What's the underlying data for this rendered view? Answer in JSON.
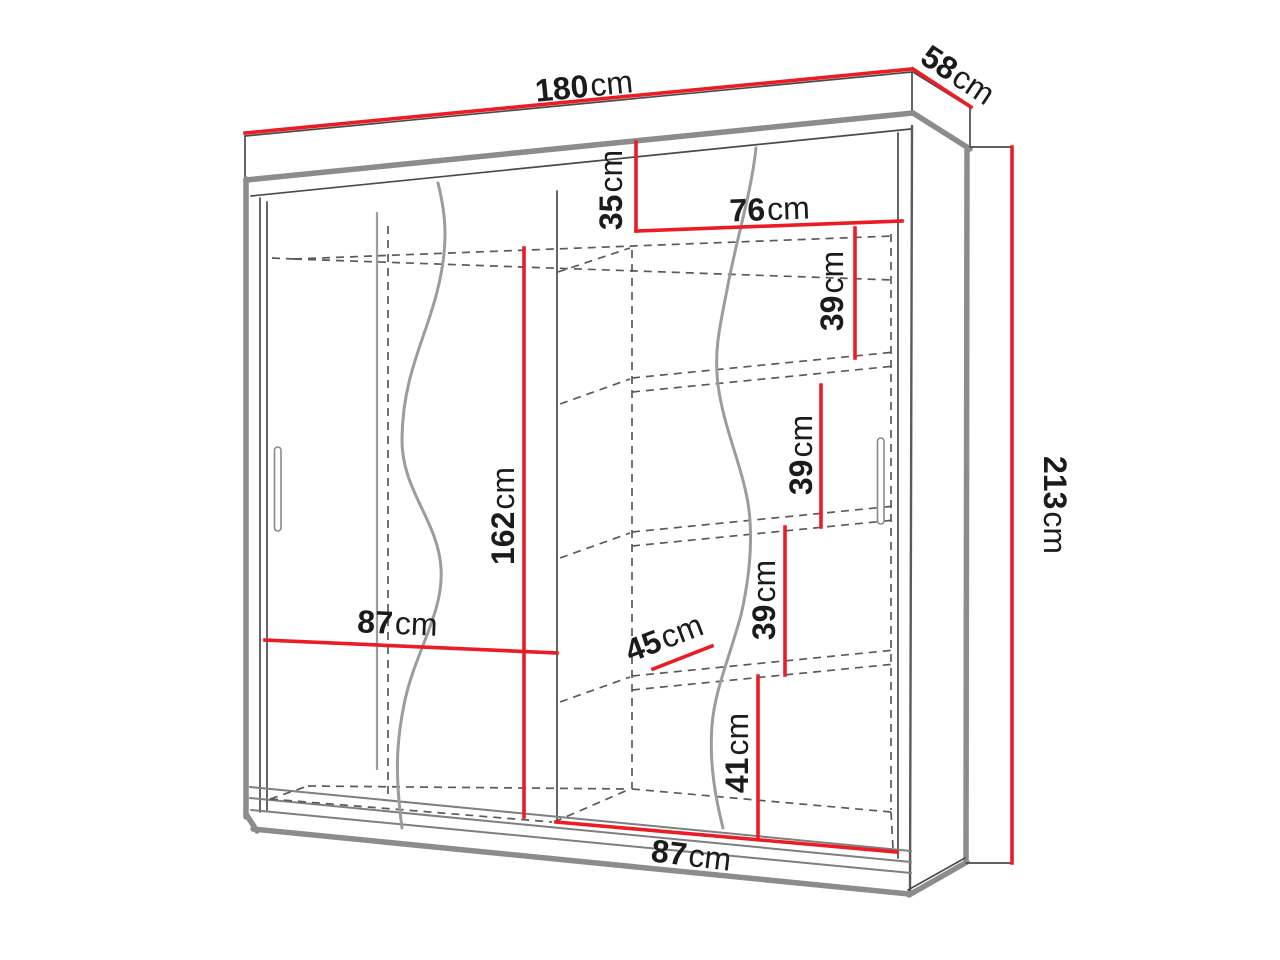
{
  "diagram": {
    "subject": "wardrobe-dimension-drawing",
    "unit": "cm",
    "colors": {
      "dimension_line": "#ec1c24",
      "outline": "#4a4a4a",
      "shadow_edge": "#8c8c8c",
      "hidden_line": "#5a5a5a",
      "label_text": "#1b1b1b",
      "background": "#ffffff"
    },
    "dimensions": {
      "width": {
        "value": "180",
        "unit": "cm"
      },
      "depth": {
        "value": "58",
        "unit": "cm"
      },
      "height": {
        "value": "213",
        "unit": "cm"
      },
      "top_section": {
        "value": "35",
        "unit": "cm"
      },
      "shelf_width": {
        "value": "76",
        "unit": "cm"
      },
      "shelf_gap_1": {
        "value": "39",
        "unit": "cm"
      },
      "shelf_gap_2": {
        "value": "39",
        "unit": "cm"
      },
      "shelf_gap_3": {
        "value": "39",
        "unit": "cm"
      },
      "hanging_height": {
        "value": "162",
        "unit": "cm"
      },
      "door_left": {
        "value": "87",
        "unit": "cm"
      },
      "shelf_depth": {
        "value": "45",
        "unit": "cm"
      },
      "bottom_gap": {
        "value": "41",
        "unit": "cm"
      },
      "door_right": {
        "value": "87",
        "unit": "cm"
      }
    }
  }
}
